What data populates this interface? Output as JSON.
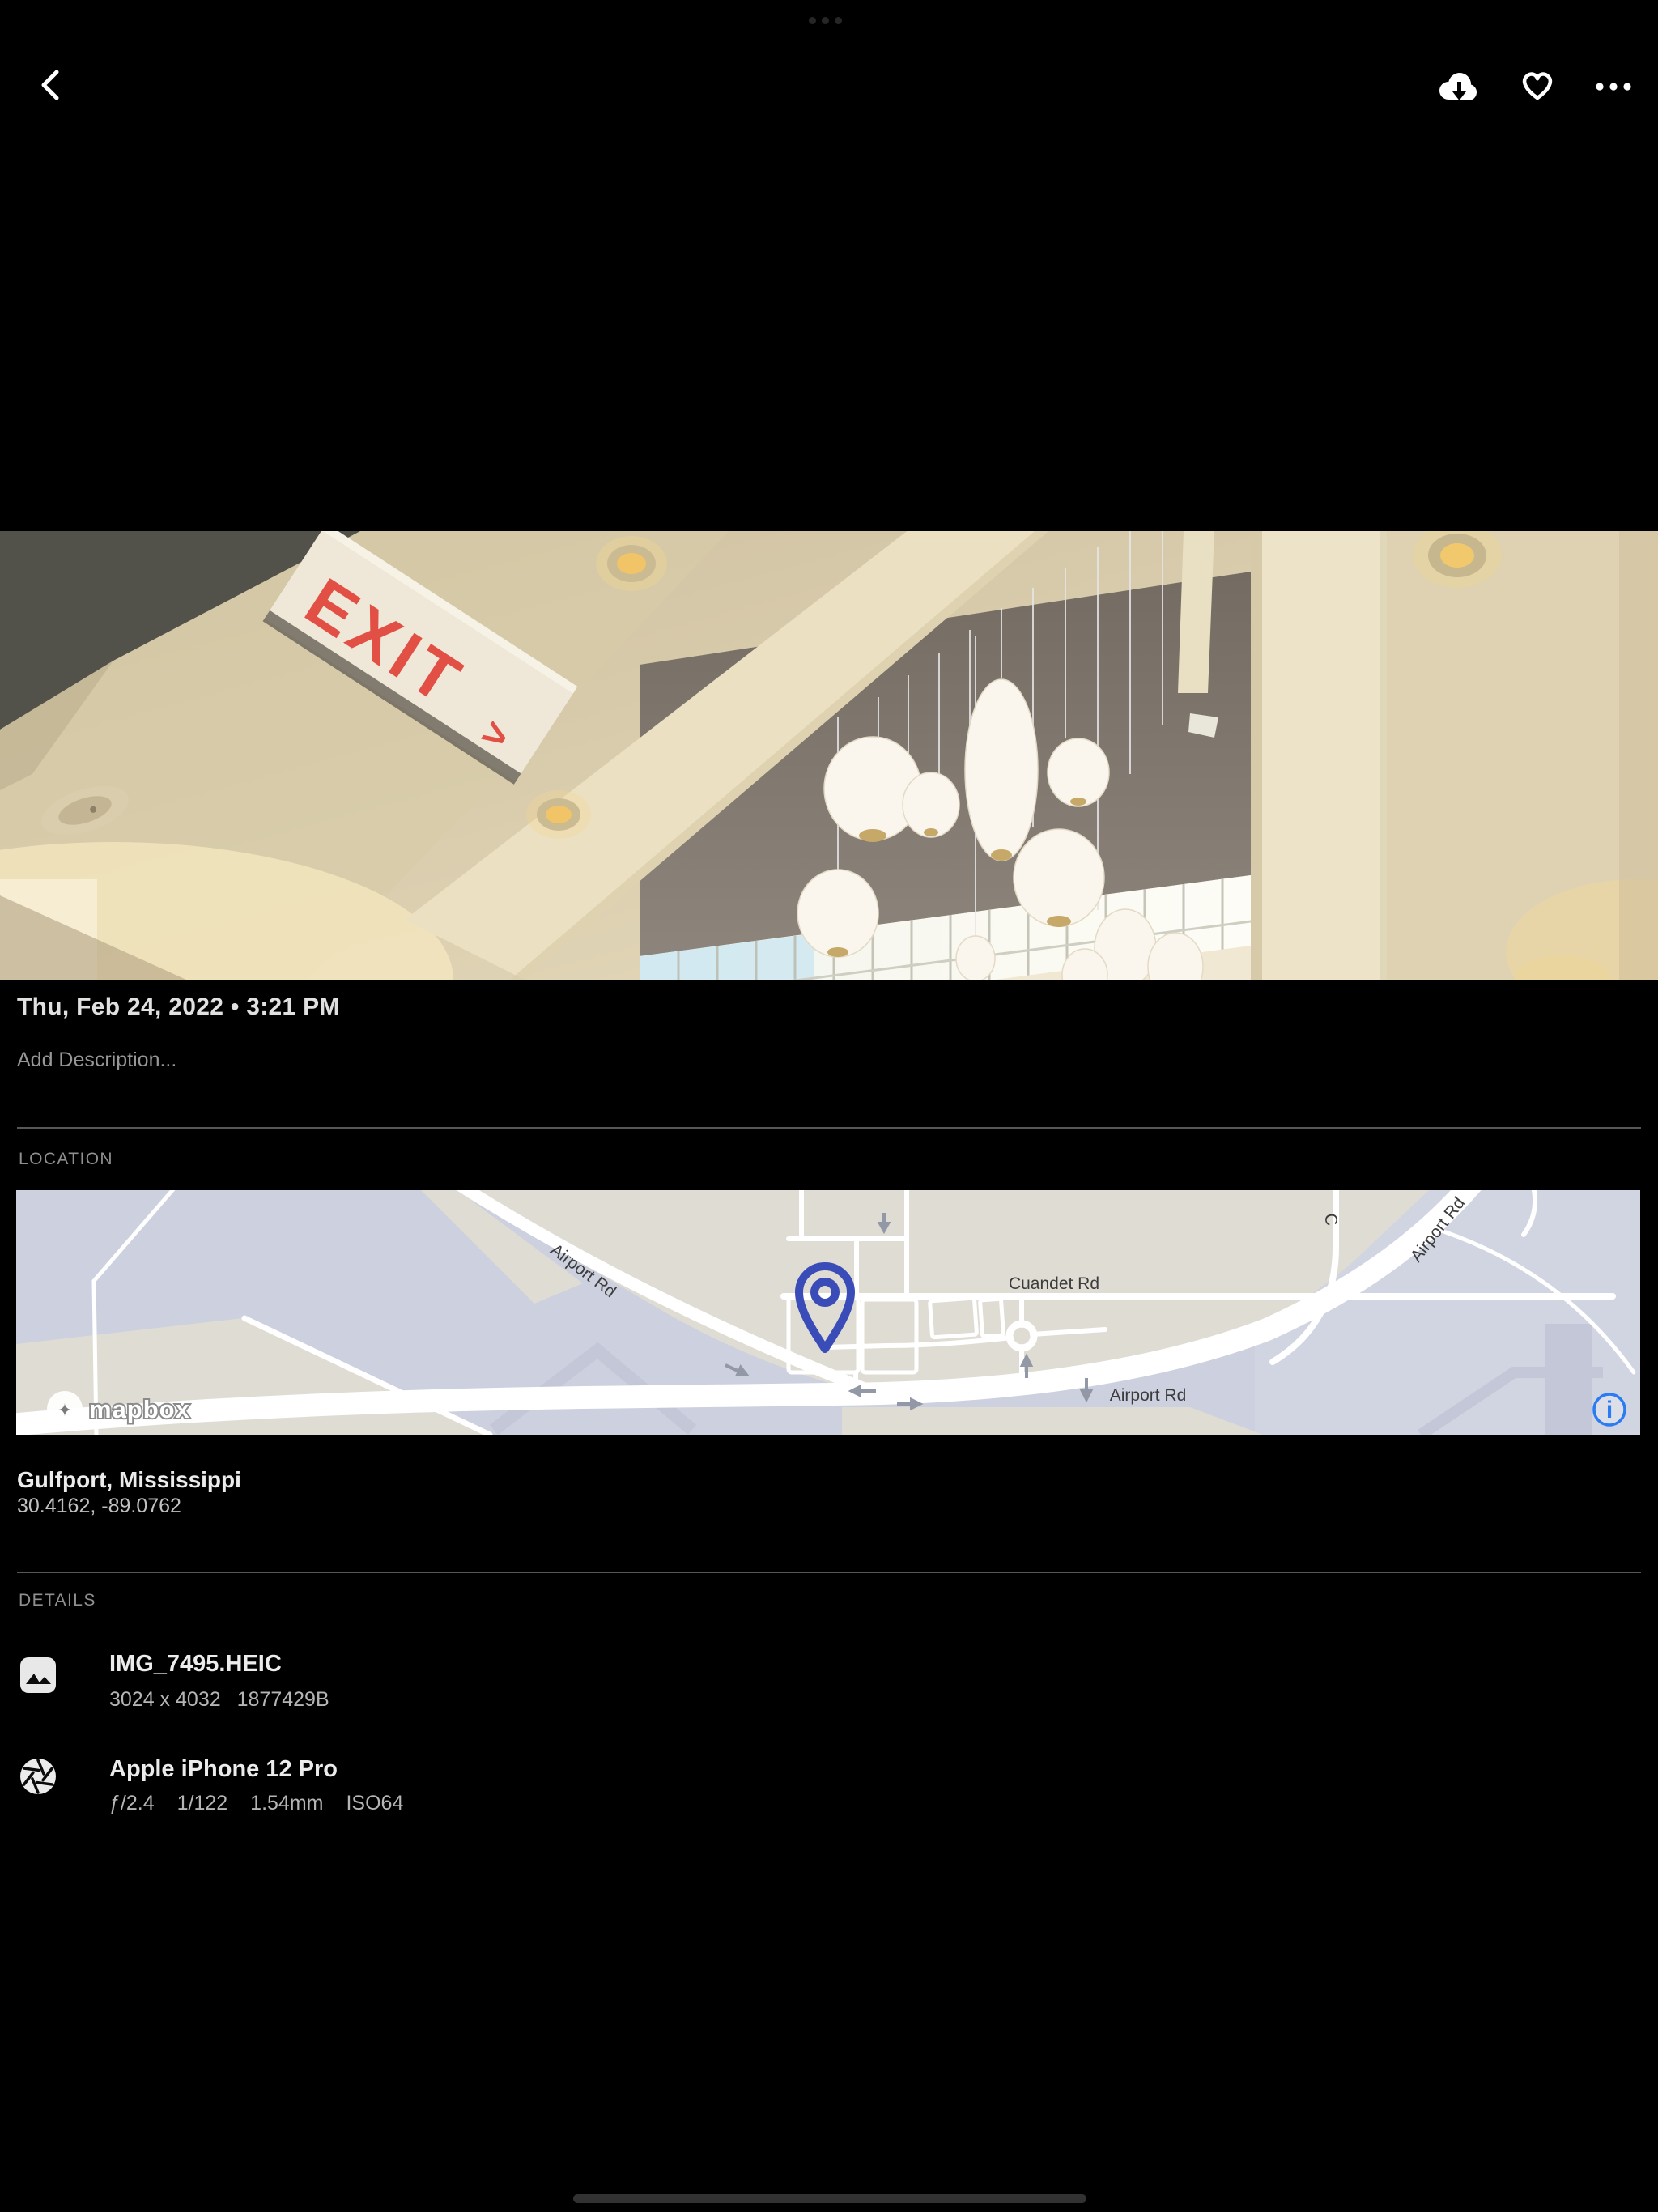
{
  "top_bar": {
    "back_icon": "chevron-left",
    "download_icon": "cloud-download",
    "favorite_icon": "heart-outline",
    "more_icon": "ellipsis-horizontal"
  },
  "photo": {
    "exit_sign": "EXIT",
    "exit_arrow": ">"
  },
  "meta": {
    "datetime": "Thu, Feb 24, 2022 • 3:21 PM",
    "description_placeholder": "Add Description..."
  },
  "location": {
    "section_label": "LOCATION",
    "place": "Gulfport, Mississippi",
    "coordinates": "30.4162, -89.0762",
    "map": {
      "attribution": "mapbox",
      "info_glyph": "i",
      "pin_icon": "map-pin",
      "labels": [
        {
          "text": "Airport Rd"
        },
        {
          "text": "Cuandet Rd"
        },
        {
          "text": "Airport Rd"
        },
        {
          "text": "C"
        },
        {
          "text": "Airport Rd"
        }
      ]
    }
  },
  "details": {
    "section_label": "DETAILS",
    "rows": [
      {
        "icon": "image",
        "title": "IMG_7495.HEIC",
        "meta": [
          "3024 x 4032",
          "1877429B"
        ]
      },
      {
        "icon": "aperture",
        "title": "Apple iPhone 12 Pro",
        "meta": [
          "ƒ/2.4",
          "1/122",
          "1.54mm",
          "ISO64"
        ]
      }
    ]
  },
  "colors": {
    "pin_indigo": "#3a4cb8",
    "info_blue": "#2b7bf3",
    "exit_red": "#e25045",
    "map_land": "#dfdcd3",
    "map_water": "#cdd0de"
  }
}
